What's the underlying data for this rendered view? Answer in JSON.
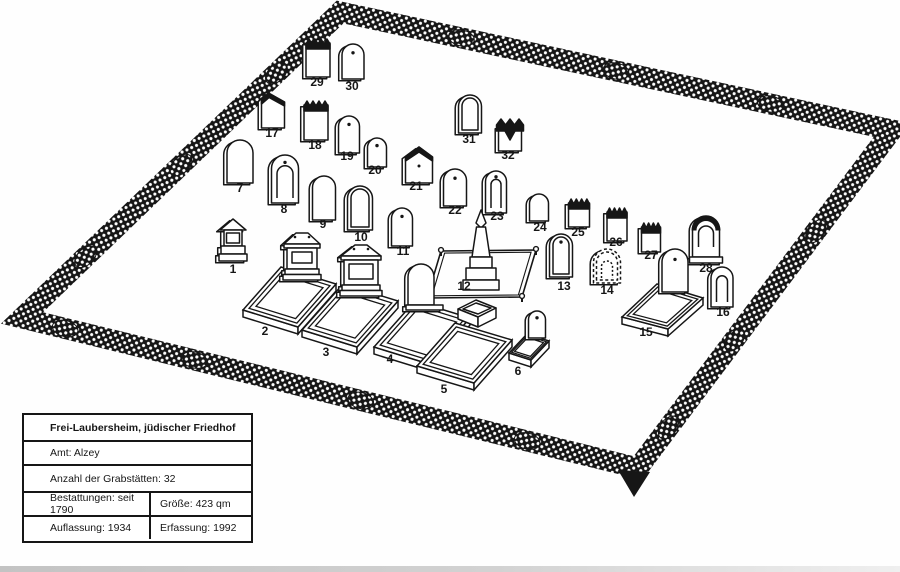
{
  "info_box": {
    "title": "Frei-Laubersheim, jüdischer Friedhof",
    "amt": "Amt: Alzey",
    "anzahl": "Anzahl der Grabstätten: 32",
    "bestattungen": "Bestattungen: seit 1790",
    "groesse": "Größe: 423 qm",
    "auflassung": "Auflassung: 1934",
    "erfassung": "Erfassung: 1992"
  },
  "colors": {
    "ink": "#161616",
    "paper": "#ffffff"
  },
  "plan": {
    "fence": {
      "corners": [
        [
          340,
          12
        ],
        [
          892,
          130
        ],
        [
          638,
          468
        ],
        [
          22,
          318
        ]
      ],
      "band_width": 21
    },
    "entrance_marker": {
      "points": [
        [
          618,
          470
        ],
        [
          650,
          472
        ],
        [
          634,
          497
        ]
      ]
    },
    "graves": [
      {
        "n": "1",
        "label": [
          233,
          269
        ],
        "stone": {
          "type": "mono",
          "x": 233,
          "y": 219,
          "w": 22,
          "h": 42
        }
      },
      {
        "n": "2",
        "label": [
          265,
          331
        ],
        "plot": [
          [
            243,
            310
          ],
          [
            281,
            267
          ],
          [
            336,
            284
          ],
          [
            298,
            327
          ]
        ],
        "stone": {
          "type": "tab",
          "x": 302,
          "y": 232,
          "w": 30,
          "h": 48
        }
      },
      {
        "n": "3",
        "label": [
          326,
          352
        ],
        "plot": [
          [
            302,
            330
          ],
          [
            343,
            284
          ],
          [
            398,
            301
          ],
          [
            357,
            347
          ]
        ],
        "stone": {
          "type": "tab",
          "x": 361,
          "y": 244,
          "w": 34,
          "h": 52
        }
      },
      {
        "n": "4",
        "label": [
          390,
          359
        ],
        "plot": [
          [
            374,
            347
          ],
          [
            415,
            301
          ],
          [
            470,
            318
          ],
          [
            429,
            364
          ]
        ],
        "stone": {
          "type": "stele",
          "x": 421,
          "y": 264,
          "w": 26,
          "h": 46
        }
      },
      {
        "n": "5",
        "label": [
          444,
          389
        ],
        "plot": [
          [
            417,
            366
          ],
          [
            455,
            323
          ],
          [
            512,
            340
          ],
          [
            474,
            383
          ]
        ],
        "stone": {
          "type": "box",
          "x": 477,
          "y": 300,
          "w": 40,
          "h": 27
        }
      },
      {
        "n": "6",
        "label": [
          518,
          371
        ],
        "plot": [
          [
            509,
            353
          ],
          [
            527,
            334
          ],
          [
            549,
            341
          ],
          [
            531,
            360
          ]
        ],
        "stone": {
          "type": "dot",
          "x": 537,
          "y": 311,
          "w": 17,
          "h": 27
        }
      },
      {
        "n": "7",
        "label": [
          240,
          188
        ],
        "stone": {
          "type": "round",
          "x": 240,
          "y": 140,
          "w": 26,
          "h": 43
        }
      },
      {
        "n": "8",
        "label": [
          284,
          209
        ],
        "stone": {
          "type": "nichedot",
          "x": 285,
          "y": 155,
          "w": 27,
          "h": 48
        }
      },
      {
        "n": "9",
        "label": [
          323,
          224
        ],
        "stone": {
          "type": "round",
          "x": 324,
          "y": 176,
          "w": 23,
          "h": 44
        }
      },
      {
        "n": "10",
        "label": [
          361,
          237
        ],
        "stone": {
          "type": "tall",
          "x": 360,
          "y": 186,
          "w": 25,
          "h": 44
        }
      },
      {
        "n": "11",
        "label": [
          403,
          251
        ],
        "stone": {
          "type": "dot",
          "x": 402,
          "y": 208,
          "w": 21,
          "h": 38
        }
      },
      {
        "n": "12",
        "label": [
          464,
          286
        ],
        "railing": [
          [
            427,
            298
          ],
          [
            441,
            251
          ],
          [
            536,
            250
          ],
          [
            522,
            297
          ]
        ],
        "stone": {
          "type": "obelisk",
          "x": 481,
          "y": 210,
          "w": 34,
          "h": 80
        }
      },
      {
        "n": "13",
        "label": [
          564,
          286
        ],
        "stone": {
          "type": "talldot",
          "x": 561,
          "y": 234,
          "w": 23,
          "h": 43
        }
      },
      {
        "n": "14",
        "label": [
          607,
          290
        ],
        "stone": {
          "type": "rough",
          "x": 607,
          "y": 249,
          "w": 27,
          "h": 34
        }
      },
      {
        "n": "15",
        "label": [
          646,
          332
        ],
        "plot": [
          [
            622,
            317
          ],
          [
            657,
            284
          ],
          [
            703,
            298
          ],
          [
            668,
            329
          ]
        ],
        "stone": {
          "type": "dot",
          "x": 675,
          "y": 249,
          "w": 26,
          "h": 43
        }
      },
      {
        "n": "16",
        "label": [
          723,
          312
        ],
        "stone": {
          "type": "niche",
          "x": 722,
          "y": 267,
          "w": 22,
          "h": 40
        }
      },
      {
        "n": "17",
        "label": [
          272,
          133
        ],
        "stone": {
          "type": "slant",
          "x": 273,
          "y": 93,
          "w": 23,
          "h": 35
        }
      },
      {
        "n": "18",
        "label": [
          315,
          145
        ],
        "stone": {
          "type": "cren",
          "x": 316,
          "y": 101,
          "w": 24,
          "h": 39
        }
      },
      {
        "n": "19",
        "label": [
          347,
          156
        ],
        "stone": {
          "type": "dot",
          "x": 349,
          "y": 116,
          "w": 21,
          "h": 37
        }
      },
      {
        "n": "20",
        "label": [
          375,
          170
        ],
        "stone": {
          "type": "dot",
          "x": 377,
          "y": 138,
          "w": 19,
          "h": 29
        }
      },
      {
        "n": "21",
        "label": [
          416,
          186
        ],
        "stone": {
          "type": "point",
          "x": 419,
          "y": 146,
          "w": 27,
          "h": 37
        }
      },
      {
        "n": "22",
        "label": [
          455,
          210
        ],
        "stone": {
          "type": "dot",
          "x": 455,
          "y": 169,
          "w": 23,
          "h": 37
        }
      },
      {
        "n": "23",
        "label": [
          497,
          216
        ],
        "stone": {
          "type": "nichedot",
          "x": 496,
          "y": 171,
          "w": 21,
          "h": 42
        }
      },
      {
        "n": "24",
        "label": [
          540,
          227
        ],
        "stone": {
          "type": "round",
          "x": 539,
          "y": 194,
          "w": 19,
          "h": 27
        }
      },
      {
        "n": "25",
        "label": [
          578,
          232
        ],
        "stone": {
          "type": "cren",
          "x": 579,
          "y": 199,
          "w": 21,
          "h": 28
        }
      },
      {
        "n": "26",
        "label": [
          616,
          242
        ],
        "stone": {
          "type": "cren",
          "x": 617,
          "y": 208,
          "w": 20,
          "h": 33
        }
      },
      {
        "n": "27",
        "label": [
          651,
          255
        ],
        "stone": {
          "type": "cren",
          "x": 651,
          "y": 223,
          "w": 19,
          "h": 29
        }
      },
      {
        "n": "28",
        "label": [
          706,
          268
        ],
        "stone": {
          "type": "ornate",
          "x": 706,
          "y": 216,
          "w": 27,
          "h": 47
        }
      },
      {
        "n": "29",
        "label": [
          317,
          82
        ],
        "stone": {
          "type": "cren",
          "x": 318,
          "y": 39,
          "w": 24,
          "h": 38
        }
      },
      {
        "n": "30",
        "label": [
          352,
          86
        ],
        "stone": {
          "type": "dot",
          "x": 353,
          "y": 44,
          "w": 22,
          "h": 35
        }
      },
      {
        "n": "31",
        "label": [
          469,
          139
        ],
        "stone": {
          "type": "tall",
          "x": 470,
          "y": 95,
          "w": 23,
          "h": 38
        }
      },
      {
        "n": "32",
        "label": [
          508,
          155
        ],
        "stone": {
          "type": "crown",
          "x": 510,
          "y": 119,
          "w": 23,
          "h": 32
        }
      }
    ]
  }
}
